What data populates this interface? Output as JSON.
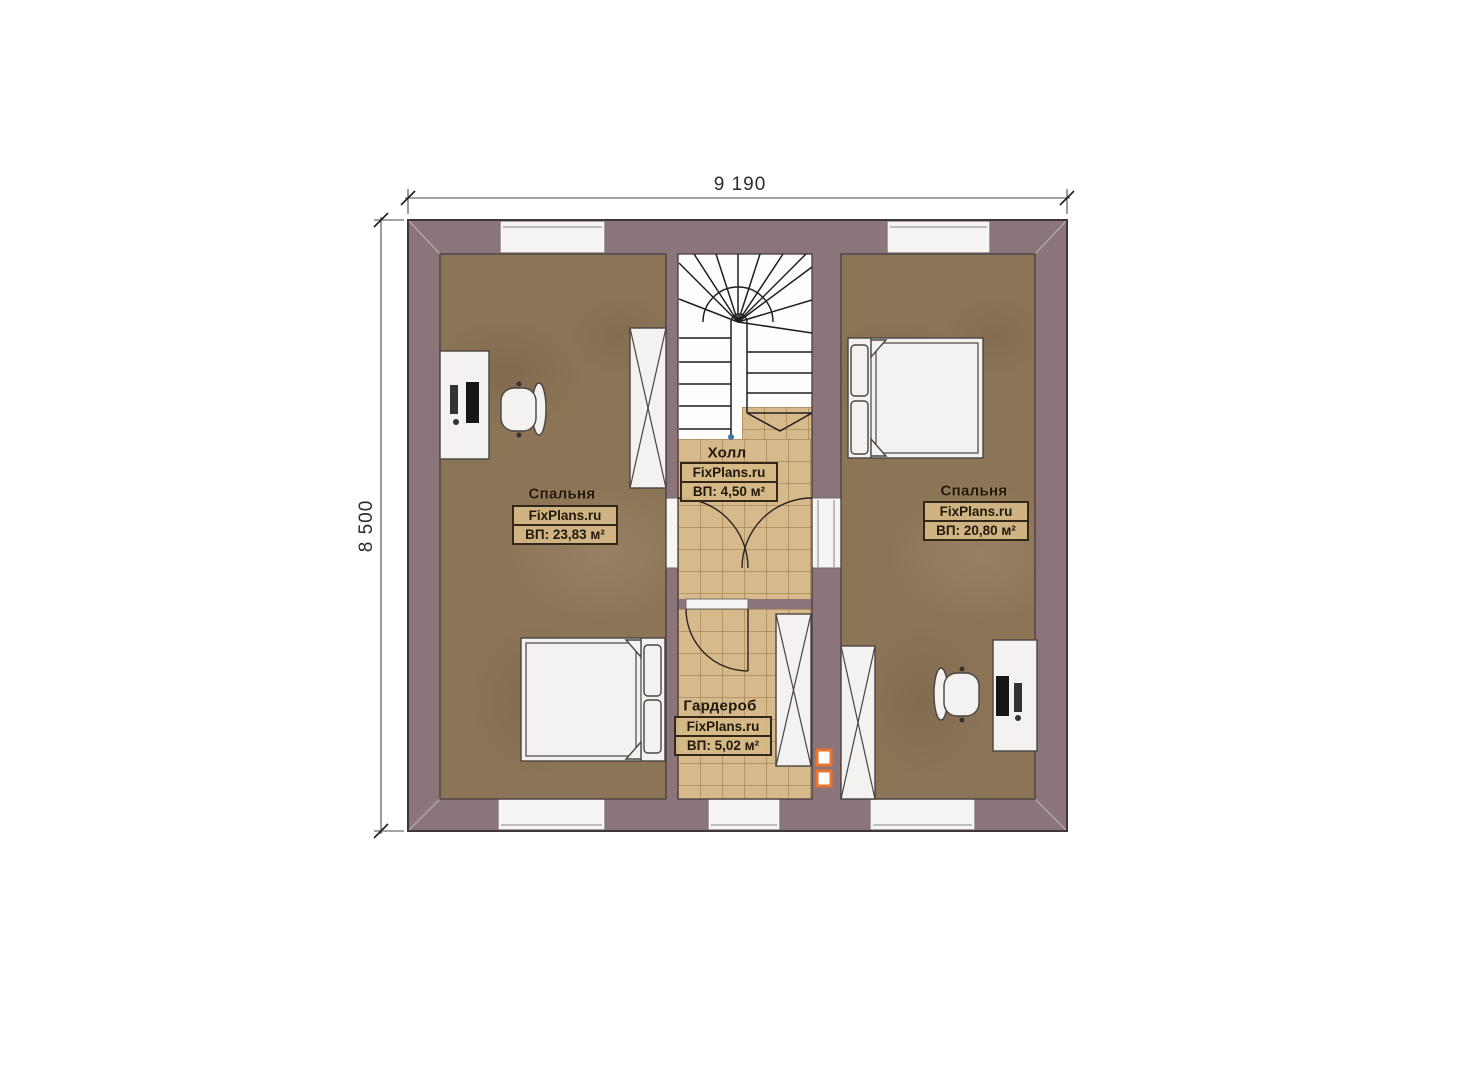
{
  "dimensions": {
    "width_label": "9 190",
    "height_label": "8 500"
  },
  "rooms": {
    "bedroom_left": {
      "name": "Спальня",
      "brand": "FixPlans.ru",
      "area": "ВП: 23,83 м²"
    },
    "hall": {
      "name": "Холл",
      "brand": "FixPlans.ru",
      "area": "ВП: 4,50 м²"
    },
    "wardrobe": {
      "name": "Гардероб",
      "brand": "FixPlans.ru",
      "area": "ВП: 5,02 м²"
    },
    "bedroom_right": {
      "name": "Спальня",
      "brand": "FixPlans.ru",
      "area": "ВП: 20,80 м²"
    }
  },
  "colors": {
    "wall": "#8c757a",
    "bedroom_floor": "#8c7457",
    "tile_floor": "#d6ba8c",
    "accent_orange": "#e8762e",
    "stair_white": "#fdfdfc",
    "line_dark": "#3f3639"
  },
  "icons": {
    "stairs-icon": "u-shaped winder staircase with direction arrow",
    "bed-icon": "double bed with two pillows and blanket folds",
    "desk-icon": "desk with monitor and keyboard",
    "office-chair-icon": "swivel chair top view",
    "wardrobe-cabinet-icon": "cabinet rectangle with X cross",
    "door-swing-icon": "quarter-circle door swing",
    "window-icon": "white window strip in wall",
    "vent-icon": "orange ventilation duct squares"
  }
}
